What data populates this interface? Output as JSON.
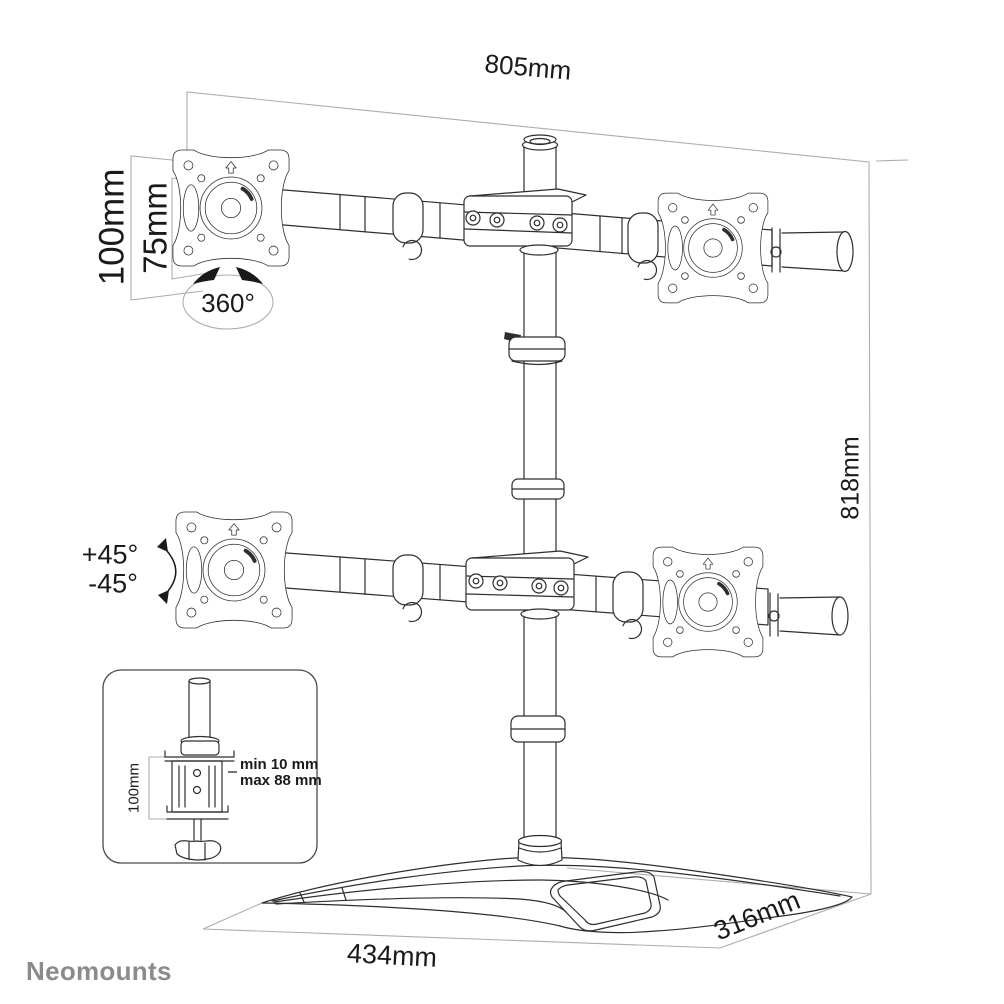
{
  "brand": {
    "logo_text": "Neomounts"
  },
  "dimensions": {
    "total_width": "805mm",
    "vesa_outer": "100mm",
    "vesa_inner": "75mm",
    "rotation": "360°",
    "tilt_up": "+45°",
    "tilt_down": "-45°",
    "total_height": "818mm",
    "base_width": "434mm",
    "base_depth": "316mm"
  },
  "clamp_inset": {
    "clamp_height": "100mm",
    "desk_thickness_min": "min 10 mm",
    "desk_thickness_max": "max 88 mm"
  }
}
